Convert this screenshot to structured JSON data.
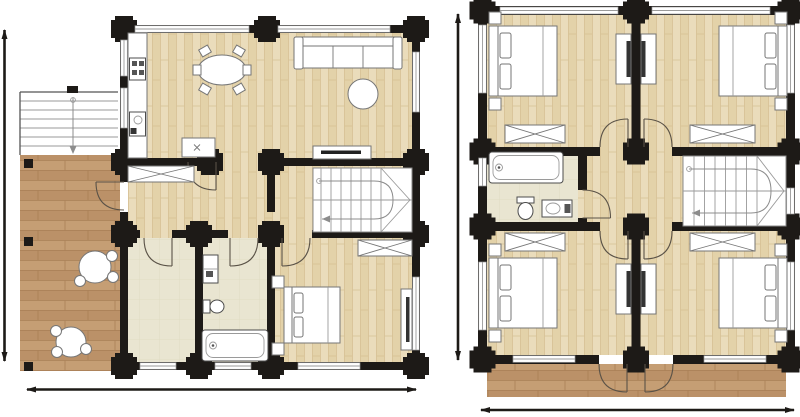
{
  "meta": {
    "description": "Two log-home architectural floor plans side by side, drawing only, no text labels",
    "image_type": "floor-plan drawing"
  },
  "palette": {
    "background": "#ffffff",
    "wall": "#1d1a17",
    "wood_floor": "#eadcbb",
    "wood_floor2": "#e3d2a9",
    "wood_plank_line": "#d6c093",
    "terrace_wood": "#c59e74",
    "terrace_wood2": "#bb9168",
    "terrace_plank_line": "#a87f55",
    "tile_floor": "#e9e5d1",
    "tile_line": "#dcd6ba",
    "furniture_stroke": "#767676",
    "fixture_stroke": "#4d4d4d",
    "furniture_dark": "#333333",
    "door_arc": "#5a5247",
    "stair_line": "#9a9a9a",
    "window_frame": "#9a9a9a",
    "walkline": "#8c8c8c",
    "dimension": "#1d1a17"
  },
  "plans": [
    {
      "id": "ground-floor-plan",
      "label": "Ground floor plan",
      "position": "left",
      "rooms": [
        "kitchen-dining",
        "living-room",
        "entrance-hall",
        "staircase",
        "utility-room",
        "bathroom",
        "bedroom",
        "terrace",
        "exterior-steps"
      ],
      "furniture": [
        {
          "name": "kitchen-counter",
          "count": 1
        },
        {
          "name": "stove",
          "count": 1
        },
        {
          "name": "kitchen-sink",
          "count": 1
        },
        {
          "name": "kitchen-island",
          "count": 1
        },
        {
          "name": "dining-table-oval",
          "count": 1
        },
        {
          "name": "dining-chair",
          "count": 6
        },
        {
          "name": "sofa-3-seat",
          "count": 1
        },
        {
          "name": "coffee-table-round",
          "count": 1
        },
        {
          "name": "tv-sideboard",
          "count": 1
        },
        {
          "name": "hall-wardrobe",
          "count": 1
        },
        {
          "name": "u-shaped-staircase",
          "count": 1
        },
        {
          "name": "double-bed",
          "count": 1
        },
        {
          "name": "nightstand",
          "count": 2
        },
        {
          "name": "bedroom-wardrobe",
          "count": 1
        },
        {
          "name": "dresser-tv",
          "count": 1
        },
        {
          "name": "bath-sink",
          "count": 1
        },
        {
          "name": "toilet",
          "count": 1
        },
        {
          "name": "bathtub",
          "count": 1
        },
        {
          "name": "terrace-table-round",
          "count": 2
        },
        {
          "name": "terrace-chair",
          "count": 6
        }
      ],
      "features": [
        "log-corner-joints",
        "door-swing-arcs",
        "window-openings",
        "steps-direction-arrow"
      ],
      "dimension_lines": [
        "vertical-left",
        "horizontal-bottom"
      ]
    },
    {
      "id": "upper-floor-plan",
      "label": "Upper floor plan",
      "position": "right",
      "rooms": [
        "bedroom-top-left",
        "bedroom-top-right",
        "bedroom-bottom-left",
        "bedroom-bottom-right",
        "bathroom",
        "landing-hall",
        "staircase",
        "balcony"
      ],
      "furniture": [
        {
          "name": "double-bed",
          "count": 4
        },
        {
          "name": "nightstand",
          "count": 8
        },
        {
          "name": "wardrobe-x",
          "count": 4
        },
        {
          "name": "desk",
          "count": 4
        },
        {
          "name": "bathtub",
          "count": 1
        },
        {
          "name": "toilet",
          "count": 1
        },
        {
          "name": "bath-sink",
          "count": 1
        },
        {
          "name": "u-shaped-staircase",
          "count": 1
        }
      ],
      "features": [
        "log-corner-joints",
        "door-swing-arcs",
        "window-openings",
        "balcony-doors"
      ],
      "dimension_lines": [
        "vertical-left",
        "horizontal-bottom"
      ]
    }
  ]
}
